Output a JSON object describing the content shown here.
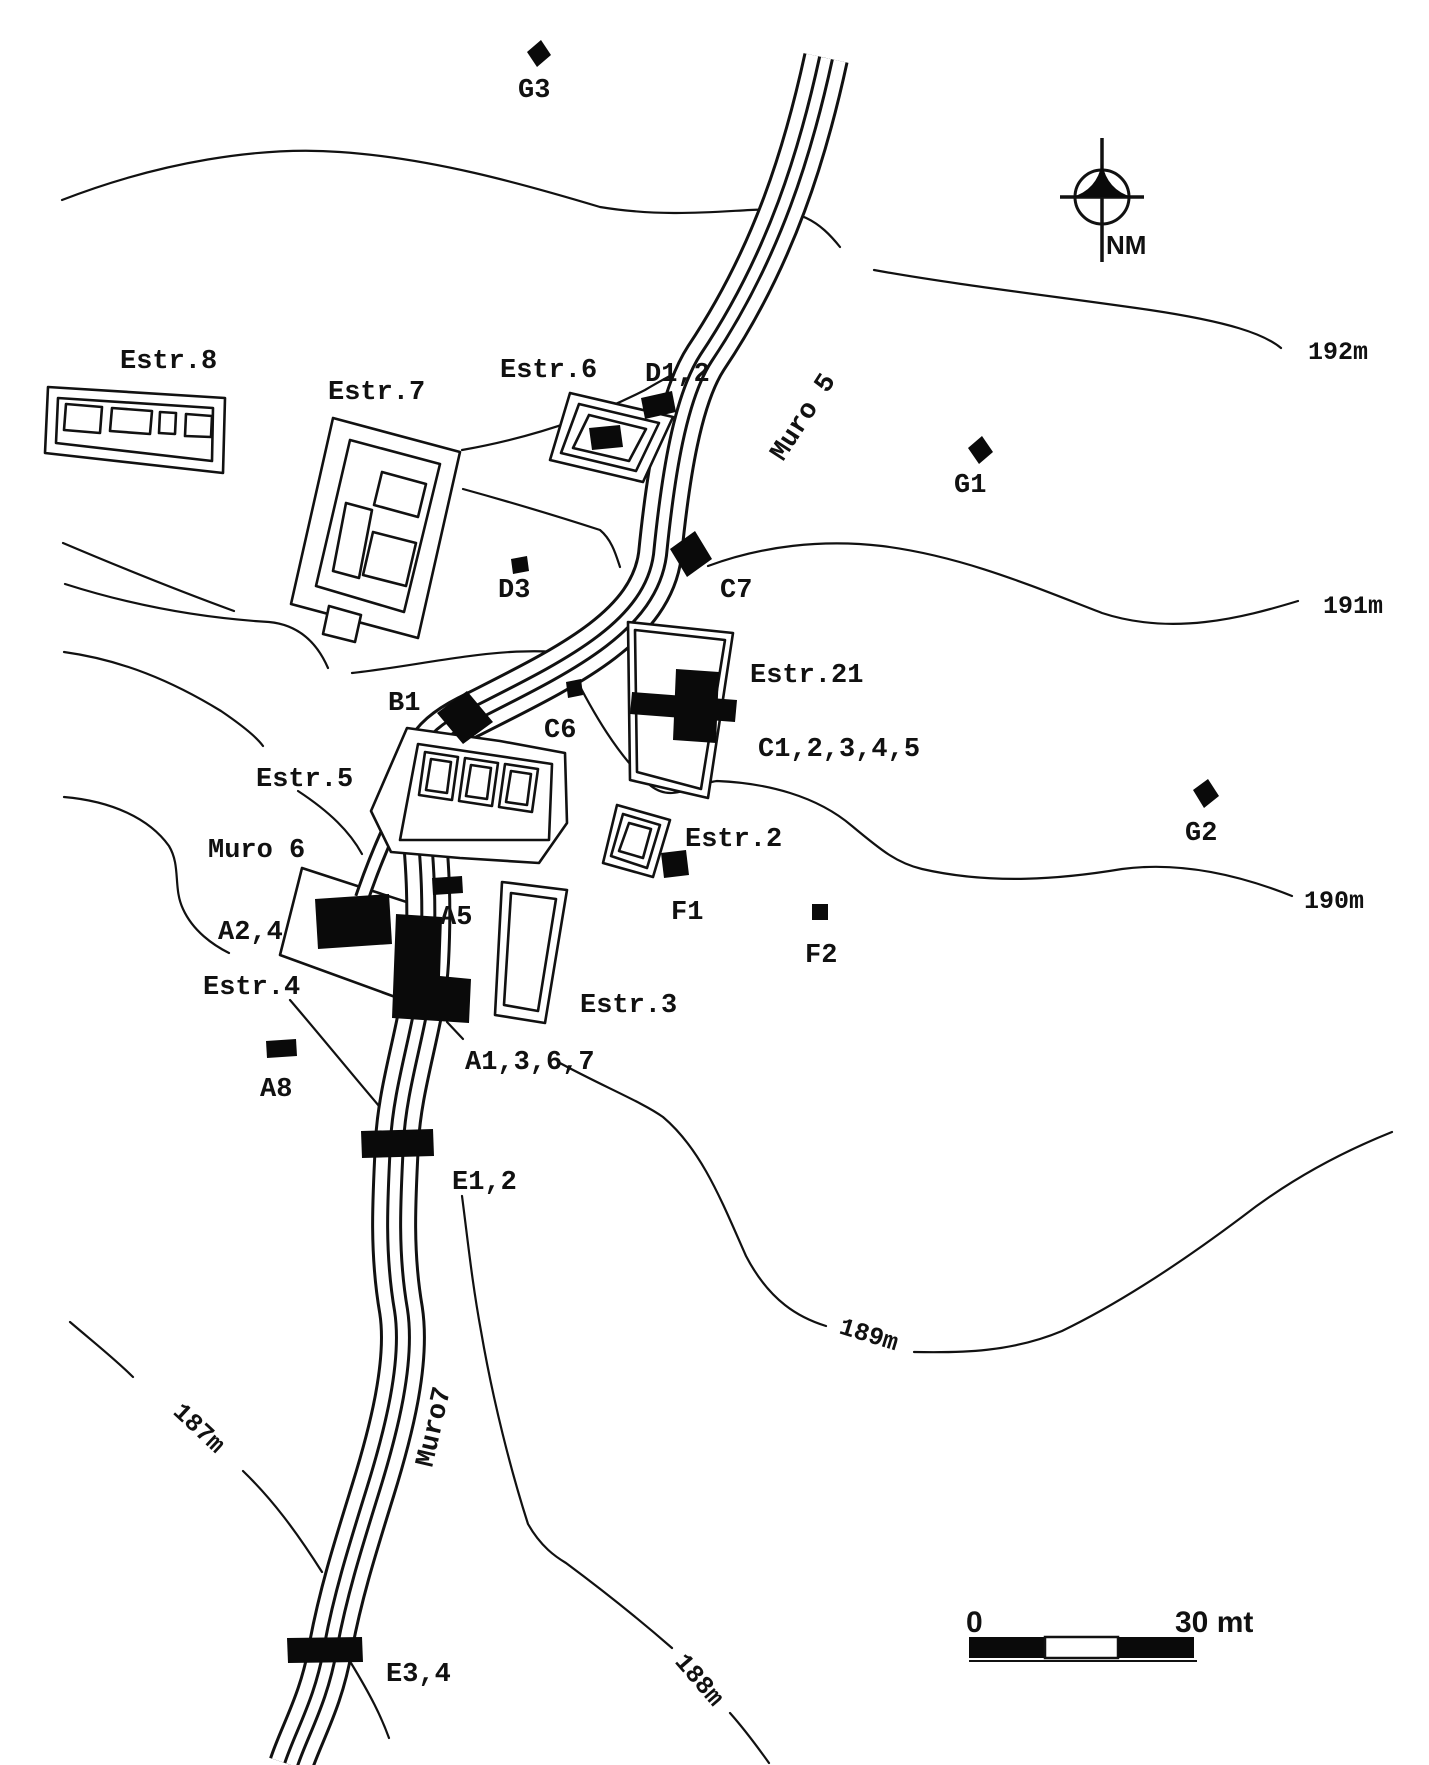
{
  "map": {
    "type": "archaeological-site-plan",
    "north_arrow": {
      "label": "NM"
    },
    "scale_bar": {
      "start": "0",
      "end": "30 mt"
    },
    "contour_lines": [
      "192m",
      "191m",
      "190m",
      "189m",
      "188m",
      "187m"
    ],
    "walls": [
      "Muro 5",
      "Muro 6",
      "Muro7"
    ],
    "structures": [
      "Estr.2",
      "Estr.3",
      "Estr.4",
      "Estr.5",
      "Estr.6",
      "Estr.7",
      "Estr.8",
      "Estr.21"
    ],
    "excavation_units": [
      "A1,3,6,7",
      "A2,4",
      "A5",
      "A8",
      "B1",
      "C1,2,3,4,5",
      "C6",
      "C7",
      "D1,2",
      "D3",
      "E1,2",
      "E3,4",
      "F1",
      "F2",
      "G1",
      "G2",
      "G3"
    ]
  },
  "labels": {
    "g3": "G3",
    "nm": "NM",
    "estr8": "Estr.8",
    "estr7": "Estr.7",
    "estr6": "Estr.6",
    "d12": "D1,2",
    "muro5": "Muro 5",
    "g1": "G1",
    "c192": "192m",
    "d3": "D3",
    "c7": "C7",
    "c191": "191m",
    "b1": "B1",
    "estr21": "Estr.21",
    "c6": "C6",
    "c12345": "C1,2,3,4,5",
    "estr5": "Estr.5",
    "g2": "G2",
    "muro6": "Muro 6",
    "estr2": "Estr.2",
    "c190": "190m",
    "f1": "F1",
    "a24": "A2,4",
    "f2": "F2",
    "a5": "A5",
    "estr4": "Estr.4",
    "estr3": "Estr.3",
    "a1367": "A1,3,6,7",
    "a8": "A8",
    "e12": "E1,2",
    "c189": "189m",
    "muro7": "Muro7",
    "c187": "187m",
    "c188": "188m",
    "e34": "E3,4",
    "scale_zero": "0",
    "scale_end": "30 mt"
  }
}
